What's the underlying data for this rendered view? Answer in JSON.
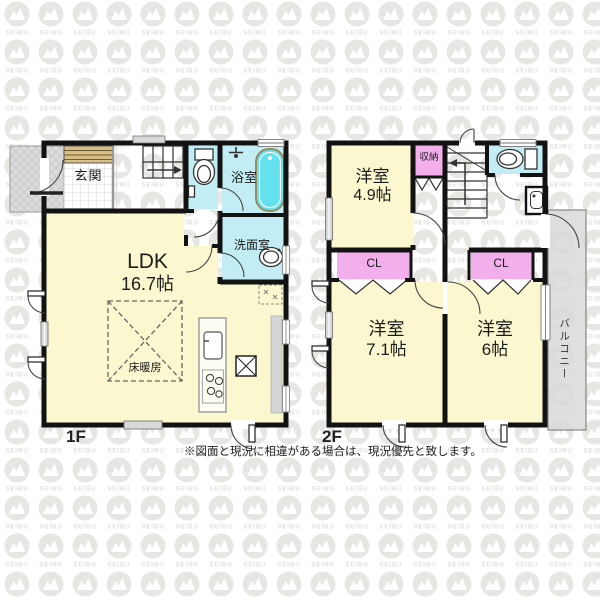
{
  "colors": {
    "wall": "#121212",
    "room_yellow": "#FBF8CF",
    "room_cyan": "#C2EDF5",
    "tub_water": "#63E1ED",
    "closet_pink": "#F3AEEC",
    "gray_area": "#DADADA",
    "cabinet_tan": "#D9BE85",
    "watermark_gray": "#E8E6E3"
  },
  "watermark": {
    "text": "SEIBU"
  },
  "floors": [
    {
      "id": "1f",
      "label": "1F",
      "rooms": [
        {
          "name": "genkan",
          "label": "玄関"
        },
        {
          "name": "ldk",
          "label": "LDK",
          "size": "16.7帖"
        },
        {
          "name": "bathroom",
          "label": "浴室"
        },
        {
          "name": "washroom",
          "label": "洗面室"
        },
        {
          "name": "floor-heating",
          "label": "床暖房"
        }
      ]
    },
    {
      "id": "2f",
      "label": "2F",
      "rooms": [
        {
          "name": "western-room-49",
          "label": "洋室",
          "size": "4.9帖"
        },
        {
          "name": "storage",
          "label": "収納"
        },
        {
          "name": "closet-left",
          "label": "CL"
        },
        {
          "name": "closet-right",
          "label": "CL"
        },
        {
          "name": "western-room-71",
          "label": "洋室",
          "size": "7.1帖"
        },
        {
          "name": "western-room-6",
          "label": "洋室",
          "size": "6帖"
        },
        {
          "name": "balcony",
          "label": "バルコニー"
        }
      ]
    }
  ],
  "footer": {
    "disclaimer": "※図面と現況に相違がある場合は、現況優先と致します。"
  }
}
